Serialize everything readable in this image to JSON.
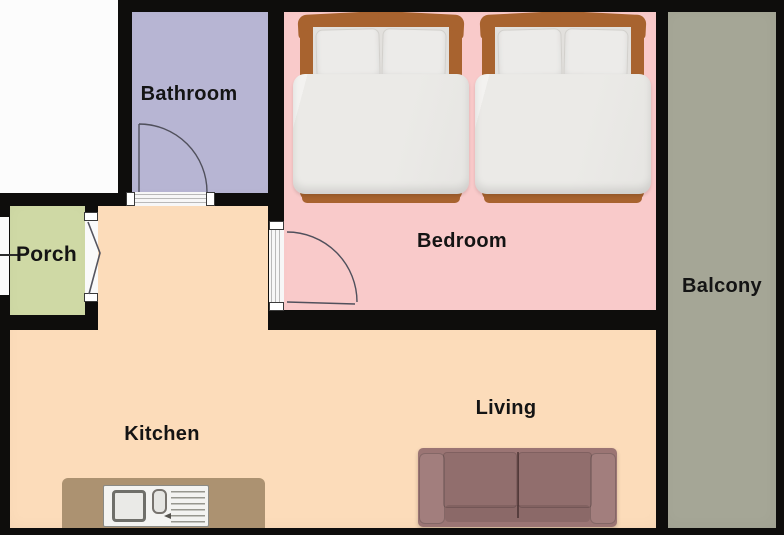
{
  "rooms": {
    "bathroom": {
      "label": "Bathroom",
      "color": "#b7b5d3"
    },
    "bedroom": {
      "label": "Bedroom",
      "color": "#f9caca"
    },
    "porch": {
      "label": "Porch",
      "color": "#cfd9a5"
    },
    "kitchen": {
      "label": "Kitchen",
      "color": "#fcdcba"
    },
    "living": {
      "label": "Living",
      "color": "#fcdcba"
    },
    "balcony": {
      "label": "Balcony",
      "color": "#a5a696"
    }
  },
  "colors": {
    "wall": "#0e0d0c",
    "outside": "#fcfcfc",
    "bed_frame": "#a8632f",
    "sofa": "#9b7574",
    "counter": "#ac9271"
  }
}
